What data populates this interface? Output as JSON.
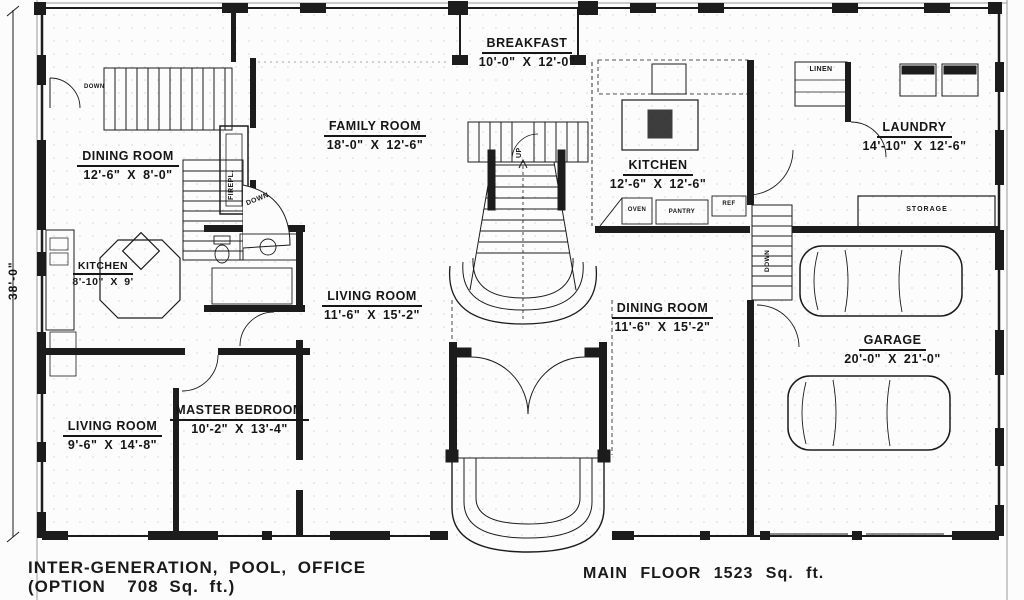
{
  "drawing_title": "house floor plan",
  "left_dimension": "38'-0\"",
  "rooms": [
    {
      "id": "breakfast",
      "name": "BREAKFAST",
      "dims": "10'-0\" X 12'-0\""
    },
    {
      "id": "family-room",
      "name": "FAMILY ROOM",
      "dims": "18'-0\" X 12'-6\""
    },
    {
      "id": "dining-room-left",
      "name": "DINING ROOM",
      "dims": "12'-6\" X 8'-0\""
    },
    {
      "id": "kitchen-left",
      "name": "KITCHEN",
      "dims": "8'-10\" X 9'"
    },
    {
      "id": "kitchen-center",
      "name": "KITCHEN",
      "dims": "12'-6\" X 12'-6\""
    },
    {
      "id": "laundry",
      "name": "LAUNDRY",
      "dims": "14'-10\" X 12'-6\""
    },
    {
      "id": "living-room-center",
      "name": "LIVING ROOM",
      "dims": "11'-6\" X 15'-2\""
    },
    {
      "id": "dining-room-right",
      "name": "DINING ROOM",
      "dims": "11'-6\" X 15'-2\""
    },
    {
      "id": "garage",
      "name": "GARAGE",
      "dims": "20'-0\" X 21'-0\""
    },
    {
      "id": "living-room-bottom",
      "name": "LIVING ROOM",
      "dims": "9'-6\" X 14'-8\""
    },
    {
      "id": "master-bedroom",
      "name": "MASTER BEDROOM",
      "dims": "10'-2\" X 13'-4\""
    }
  ],
  "labels": {
    "linen": "LINEN",
    "fireplace": "FIREPL.",
    "oven": "OVEN",
    "pantry": "PANTRY",
    "ref": "REF",
    "storage": "STORAGE",
    "down": "DOWN",
    "up": "UP"
  },
  "captions": {
    "option_line1": "INTER-GENERATION, POOL, OFFICE",
    "option_line2": "(OPTION  708 Sq. ft.)",
    "main_floor": "MAIN FLOOR 1523 Sq. ft."
  },
  "colors": {
    "ink": "#1c1c1c",
    "paper": "#fcfcfc",
    "dot_texture": "#b5b5b5"
  }
}
